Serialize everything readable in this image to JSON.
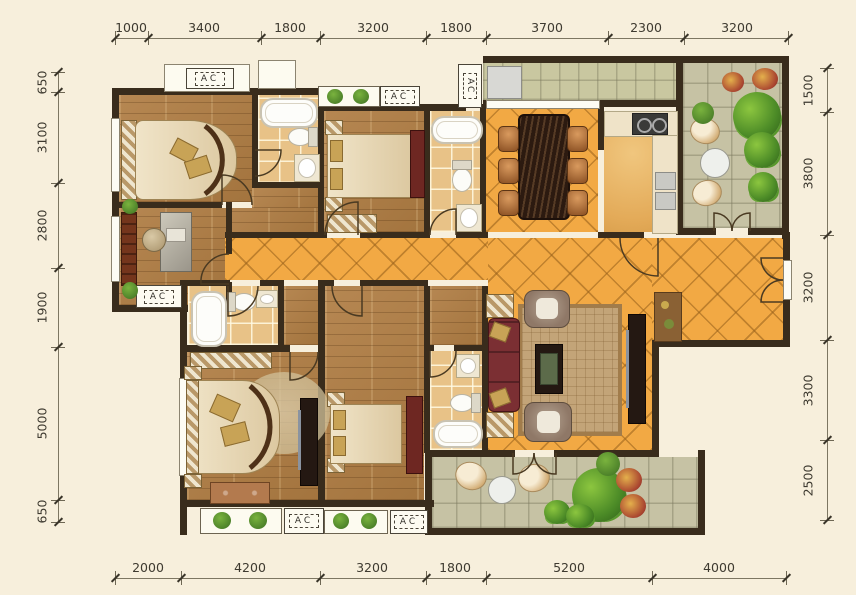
{
  "dimensions": {
    "top": [
      "1000",
      "3400",
      "1800",
      "3200",
      "1800",
      "3700",
      "2300",
      "3200"
    ],
    "bottom": [
      "2000",
      "4200",
      "3200",
      "1800",
      "5200",
      "4000"
    ],
    "left": [
      "650",
      "3100",
      "2800",
      "1900",
      "5000",
      "650"
    ],
    "right": [
      "1500",
      "3800",
      "3200",
      "3300",
      "2500"
    ]
  },
  "labels": {
    "ac": "AC"
  },
  "colors": {
    "background": "#f7efdc",
    "wall": "#392c1c",
    "wood_floor": "#b08048",
    "orange_tile": "#f2a944",
    "bath_tile": "#e8c287",
    "balcony_tile": "#c6c2a4",
    "sofa": "#7b2f33",
    "plant": "#4c8b27",
    "dimension_text": "#3e3a30"
  }
}
